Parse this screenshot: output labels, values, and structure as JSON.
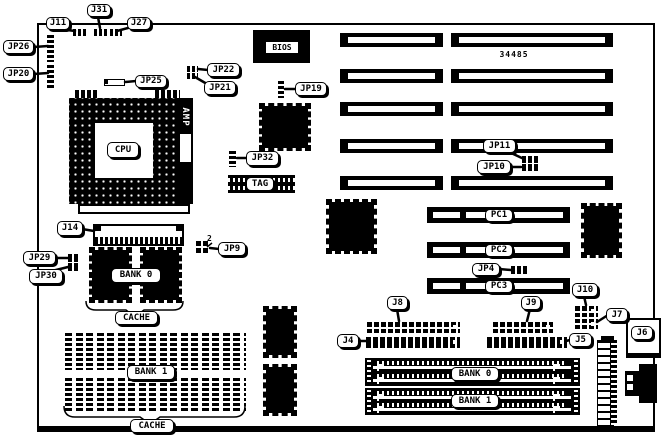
{
  "labels": {
    "j11": "J11",
    "j31": "J31",
    "j27": "J27",
    "jp26": "JP26",
    "jp20": "JP20",
    "jp25": "JP25",
    "jp22": "JP22",
    "jp21": "JP21",
    "jp19": "JP19",
    "jp32": "JP32",
    "jp11": "JP11",
    "jp10": "JP10",
    "jp4": "JP4",
    "jp9": "JP9",
    "jp29": "JP29",
    "jp30": "JP30",
    "j14": "J14",
    "j8": "J8",
    "j9": "J9",
    "j10": "J10",
    "j7": "J7",
    "j4": "J4",
    "j5": "J5",
    "j6": "J6"
  },
  "chips": {
    "bios": "BIOS",
    "cpu": "CPU",
    "amp": "AMP",
    "tag": "TAG"
  },
  "slots": {
    "pc1": "PC1",
    "pc2": "PC2",
    "pc3": "PC3"
  },
  "memory": {
    "cache_chip_bank": "BANK 0",
    "cache_dip_bank": "BANK 1",
    "cache_top": "CACHE",
    "cache_bottom": "CACHE",
    "simm_bank0": "BANK 0",
    "simm_bank1": "BANK 1"
  },
  "annotations": {
    "board_number": "34485",
    "jp9_pin": "2"
  },
  "colors": {
    "line": "#000000",
    "bg": "#ffffff"
  }
}
